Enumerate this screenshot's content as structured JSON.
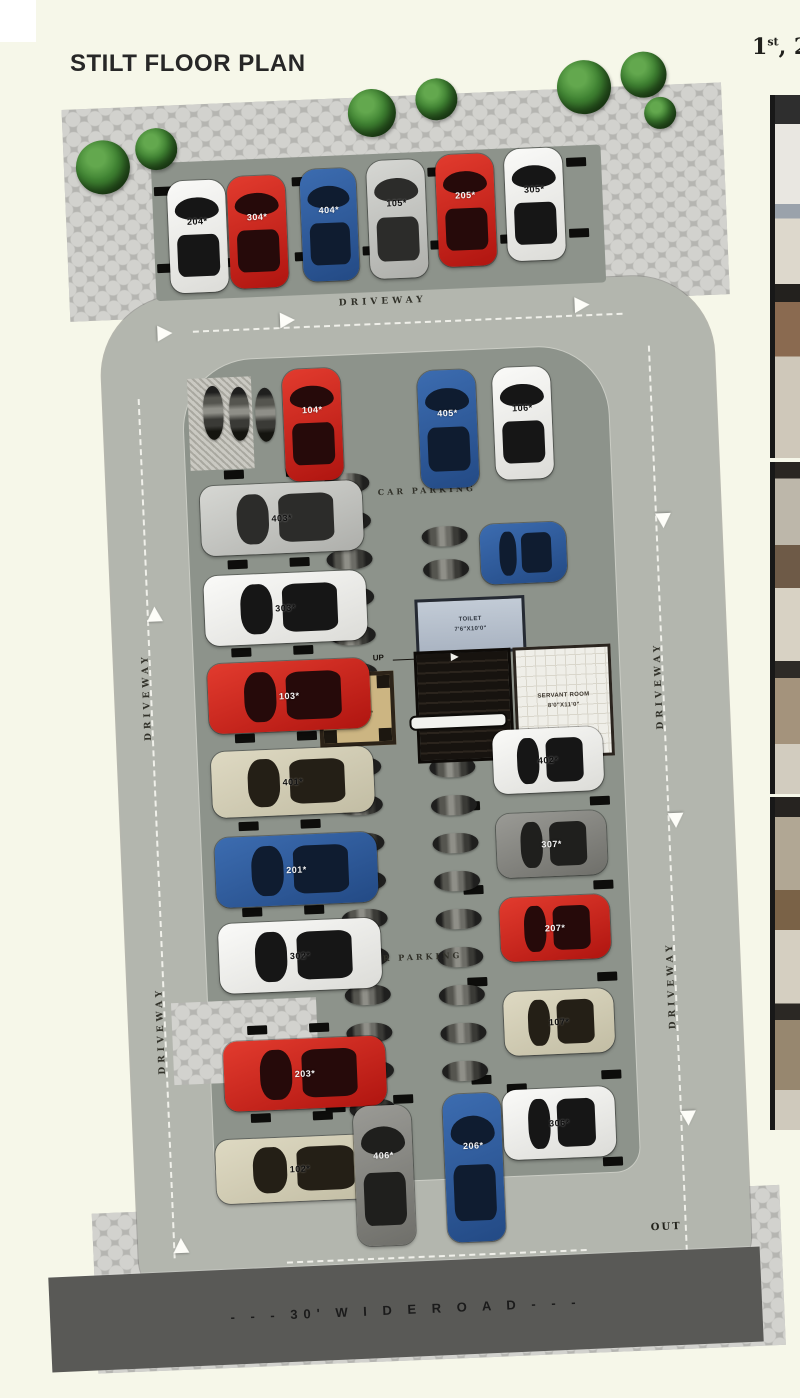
{
  "page": {
    "title": "STILT FLOOR PLAN"
  },
  "header_right": {
    "num": "1",
    "sup": "st",
    "rest": ", 2"
  },
  "road": {
    "label": "- - -  30' W I D E   R O A D  - - -"
  },
  "markers": {
    "in": "IN",
    "out": "OUT",
    "up": "UP"
  },
  "labels": {
    "driveway": "DRIVEWAY",
    "car_parking": "CAR PARKING"
  },
  "structures": {
    "toilet": {
      "name": "TOILET",
      "dims": "7'6\"X10'0\""
    },
    "servant": {
      "name": "SERVANT ROOM",
      "dims": "8'0\"X11'0\""
    },
    "lift": {
      "name": "LIFT",
      "dims": "5'6\"X5'6\""
    }
  },
  "colors": {
    "background": "#f6f7e9",
    "deck": "#b3b6ae",
    "island": "#8d938b",
    "paver": "#c9c9c5",
    "road": "#595956",
    "car_red": "#c4211e",
    "car_blue": "#2e5c9e",
    "car_white": "#efefed",
    "car_silver": "#c8c9c5",
    "car_gray": "#85847f",
    "car_beige": "#d5d0b8"
  },
  "plan": {
    "trees": [
      [
        40,
        70,
        54
      ],
      [
        100,
        60,
        42
      ],
      [
        314,
        30,
        48
      ],
      [
        382,
        22,
        42
      ],
      [
        524,
        10,
        54
      ],
      [
        588,
        4,
        46
      ],
      [
        610,
        50,
        32
      ]
    ],
    "driveway_labels": [
      [
        297,
        238,
        0
      ],
      [
        84,
        672,
        1
      ],
      [
        84,
        1006,
        1
      ],
      [
        596,
        682,
        1
      ],
      [
        596,
        982,
        1
      ]
    ],
    "parking_labels": [
      [
        328,
        428
      ],
      [
        295,
        894
      ]
    ],
    "dashes": [
      [
        150,
        264,
        430,
        0
      ],
      [
        92,
        330,
        860,
        1
      ],
      [
        604,
        298,
        906,
        1
      ],
      [
        205,
        1198,
        300,
        0
      ]
    ],
    "arrows": [
      [
        92,
        538,
        0
      ],
      [
        92,
        1170,
        0
      ],
      [
        604,
        466,
        180
      ],
      [
        604,
        766,
        180
      ],
      [
        604,
        1064,
        180
      ],
      [
        237,
        250,
        90
      ],
      [
        532,
        247,
        90
      ],
      [
        114,
        258,
        90
      ]
    ],
    "stops": [
      [
        117,
        119
      ],
      [
        255,
        115
      ],
      [
        391,
        111
      ],
      [
        530,
        107
      ],
      [
        117,
        196
      ],
      [
        182,
        193
      ],
      [
        255,
        190
      ],
      [
        323,
        187
      ],
      [
        391,
        184
      ],
      [
        461,
        181
      ],
      [
        530,
        178
      ],
      [
        175,
        405
      ],
      [
        237,
        405
      ],
      [
        175,
        495
      ],
      [
        237,
        495
      ],
      [
        175,
        583
      ],
      [
        237,
        583
      ],
      [
        175,
        669
      ],
      [
        237,
        669
      ],
      [
        175,
        757
      ],
      [
        237,
        757
      ],
      [
        175,
        843
      ],
      [
        237,
        843
      ],
      [
        175,
        961
      ],
      [
        237,
        961
      ],
      [
        175,
        1049
      ],
      [
        237,
        1049
      ],
      [
        397,
        660
      ],
      [
        527,
        660
      ],
      [
        397,
        746
      ],
      [
        527,
        746
      ],
      [
        397,
        830
      ],
      [
        527,
        830
      ],
      [
        397,
        922
      ],
      [
        527,
        922
      ],
      [
        397,
        1020
      ],
      [
        527,
        1020
      ],
      [
        250,
        1042
      ],
      [
        318,
        1036
      ],
      [
        432,
        1030
      ],
      [
        525,
        1107
      ]
    ],
    "bikes": [
      [
        157,
        320,
        1
      ],
      [
        183,
        322,
        1
      ],
      [
        209,
        324,
        1
      ],
      [
        274,
        413,
        0
      ],
      [
        274,
        451,
        0
      ],
      [
        274,
        489,
        0
      ],
      [
        274,
        527,
        0
      ],
      [
        274,
        565,
        0
      ],
      [
        274,
        603,
        0
      ],
      [
        274,
        697,
        0
      ],
      [
        274,
        735,
        0
      ],
      [
        274,
        773,
        0
      ],
      [
        274,
        811,
        0
      ],
      [
        274,
        849,
        0
      ],
      [
        274,
        887,
        0
      ],
      [
        274,
        925,
        0
      ],
      [
        274,
        963,
        0
      ],
      [
        274,
        1001,
        0
      ],
      [
        274,
        1039,
        0
      ],
      [
        368,
        663,
        0
      ],
      [
        368,
        701,
        0
      ],
      [
        368,
        739,
        0
      ],
      [
        368,
        777,
        0
      ],
      [
        368,
        815,
        0
      ],
      [
        368,
        853,
        0
      ],
      [
        368,
        891,
        0
      ],
      [
        368,
        929,
        0
      ],
      [
        368,
        967,
        0
      ],
      [
        368,
        1005,
        0
      ],
      [
        370,
        470,
        0
      ],
      [
        370,
        503,
        0
      ]
    ],
    "cars": [
      {
        "label": "204*",
        "c": "white",
        "o": "v",
        "x": 130,
        "y": 114,
        "w": 58,
        "h": 112,
        "lt": "d"
      },
      {
        "label": "304*",
        "c": "red",
        "o": "v",
        "x": 190,
        "y": 112,
        "w": 58,
        "h": 112,
        "lt": "w"
      },
      {
        "label": "404*",
        "c": "blue",
        "o": "v",
        "x": 263,
        "y": 108,
        "w": 56,
        "h": 112,
        "lt": "w"
      },
      {
        "label": "105*",
        "c": "silver",
        "o": "v",
        "x": 330,
        "y": 102,
        "w": 58,
        "h": 118,
        "lt": "d"
      },
      {
        "label": "205*",
        "c": "red",
        "o": "v",
        "x": 399,
        "y": 99,
        "w": 58,
        "h": 112,
        "lt": "w"
      },
      {
        "label": "305*",
        "c": "white",
        "o": "v",
        "x": 468,
        "y": 96,
        "w": 58,
        "h": 112,
        "lt": "d"
      },
      {
        "label": "104*",
        "c": "red",
        "o": "v",
        "x": 237,
        "y": 307,
        "w": 58,
        "h": 112,
        "lt": "w"
      },
      {
        "label": "405*",
        "c": "blue",
        "o": "v",
        "x": 372,
        "y": 314,
        "w": 58,
        "h": 118,
        "lt": "w"
      },
      {
        "label": "106*",
        "c": "white",
        "o": "v",
        "x": 447,
        "y": 314,
        "w": 58,
        "h": 112,
        "lt": "d"
      },
      {
        "label": "",
        "c": "blue",
        "o": "h",
        "x": 428,
        "y": 470,
        "w": 86,
        "h": 60
      },
      {
        "label": "403*",
        "c": "silver",
        "o": "h",
        "x": 150,
        "y": 420,
        "w": 162,
        "h": 70,
        "lt": "d"
      },
      {
        "label": "303*",
        "c": "white",
        "o": "h",
        "x": 150,
        "y": 510,
        "w": 162,
        "h": 70,
        "lt": "d"
      },
      {
        "label": "103*",
        "c": "red",
        "o": "h",
        "x": 150,
        "y": 598,
        "w": 162,
        "h": 70,
        "lt": "w"
      },
      {
        "label": "401*",
        "c": "beige",
        "o": "h",
        "x": 150,
        "y": 686,
        "w": 162,
        "h": 66,
        "lt": "d"
      },
      {
        "label": "201*",
        "c": "blue",
        "o": "h",
        "x": 150,
        "y": 772,
        "w": 162,
        "h": 70,
        "lt": "w"
      },
      {
        "label": "302*",
        "c": "white",
        "o": "h",
        "x": 150,
        "y": 858,
        "w": 162,
        "h": 70,
        "lt": "d"
      },
      {
        "label": "203*",
        "c": "red",
        "o": "h",
        "x": 150,
        "y": 976,
        "w": 162,
        "h": 70,
        "lt": "w"
      },
      {
        "label": "102*",
        "c": "beige",
        "o": "h",
        "x": 138,
        "y": 1074,
        "w": 168,
        "h": 64,
        "lt": "d"
      },
      {
        "label": "402*",
        "c": "white",
        "o": "h",
        "x": 432,
        "y": 676,
        "w": 110,
        "h": 64,
        "lt": "d"
      },
      {
        "label": "307*",
        "c": "gray",
        "o": "h",
        "x": 432,
        "y": 760,
        "w": 110,
        "h": 64,
        "lt": "w"
      },
      {
        "label": "207*",
        "c": "red",
        "o": "h",
        "x": 432,
        "y": 844,
        "w": 110,
        "h": 64,
        "lt": "w"
      },
      {
        "label": "107*",
        "c": "beige",
        "o": "h",
        "x": 432,
        "y": 938,
        "w": 110,
        "h": 64,
        "lt": "d"
      },
      {
        "label": "306*",
        "c": "white",
        "o": "h",
        "x": 427,
        "y": 1036,
        "w": 112,
        "h": 70,
        "lt": "d"
      },
      {
        "label": "406*",
        "c": "gray",
        "o": "v",
        "x": 277,
        "y": 1046,
        "w": 58,
        "h": 140,
        "lt": "w"
      },
      {
        "label": "206*",
        "c": "blue",
        "o": "v",
        "x": 367,
        "y": 1038,
        "w": 58,
        "h": 148,
        "lt": "w"
      }
    ]
  }
}
